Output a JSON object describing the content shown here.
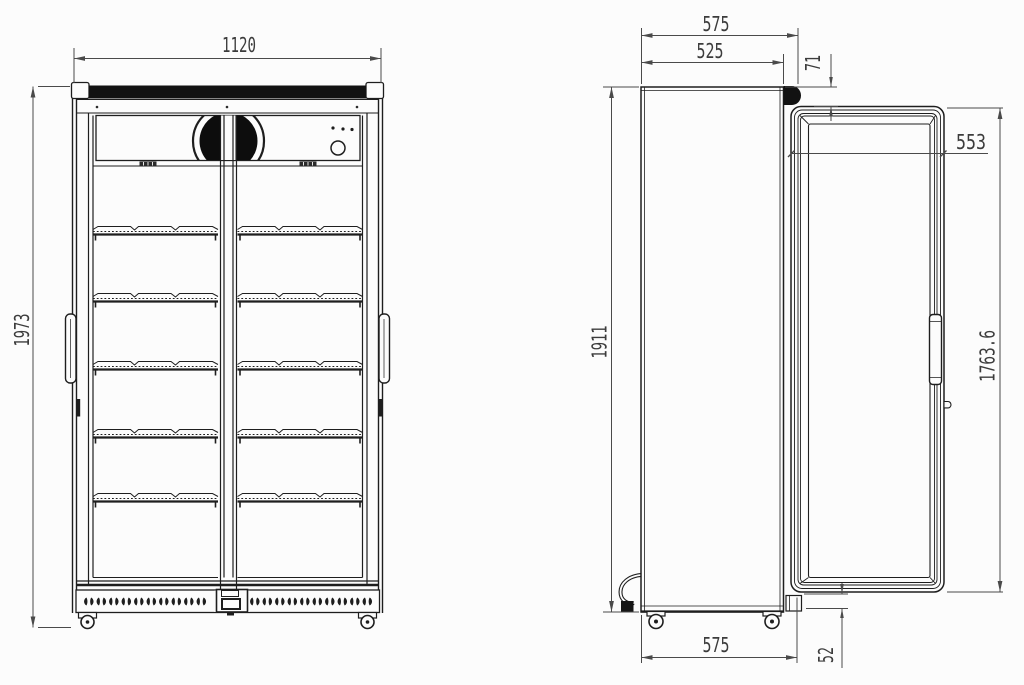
{
  "labels": {
    "front": {
      "width": "1120",
      "overall_height": "1973"
    },
    "side": {
      "depth_overall": "575",
      "depth_body": "525",
      "top_hinge_offset": "71",
      "door_width": "553",
      "body_height": "1911",
      "door_height": "1763.6",
      "base_depth": "575",
      "door_bottom_offset": "52"
    }
  },
  "colors": {
    "background": "#fcfcfc",
    "line": "#1e1e1e",
    "dimension": "#4a4a4a",
    "text": "#3c3c3c",
    "dark_fill": "#121212"
  }
}
